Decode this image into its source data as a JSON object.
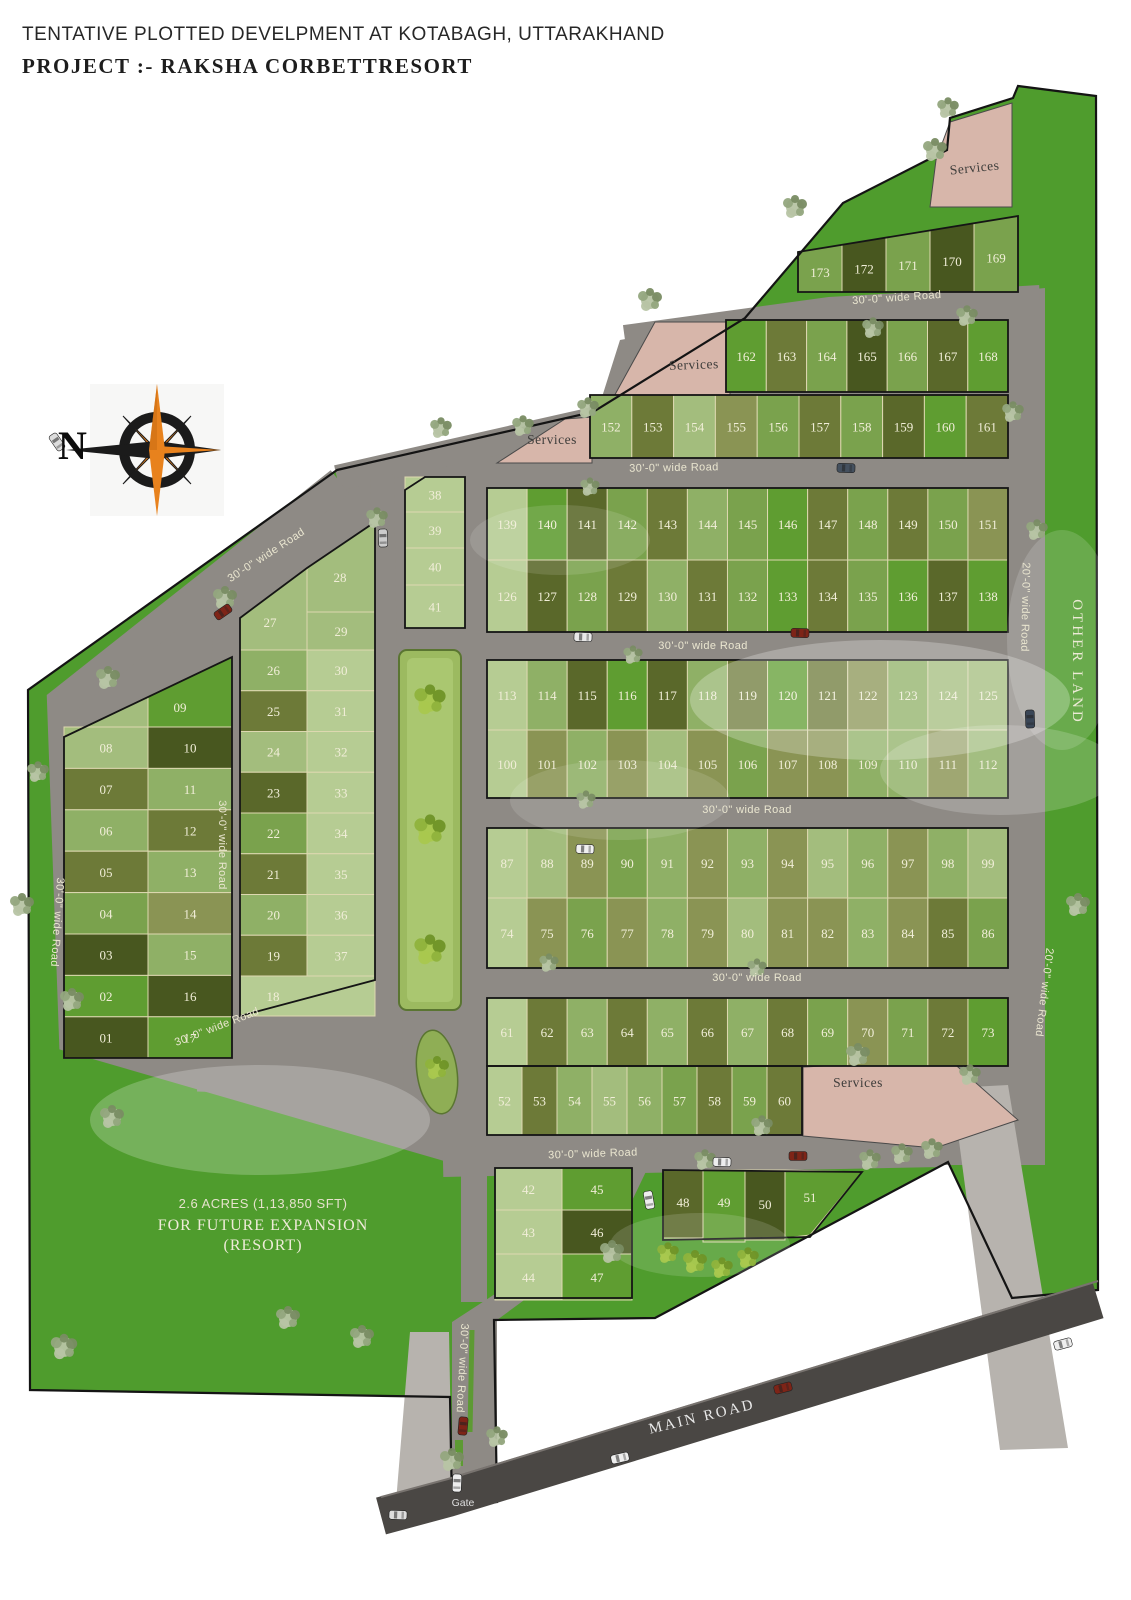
{
  "title": {
    "line1": "TENTATIVE PLOTTED DEVELPMENT AT KOTABAGH, UTTARAKHAND",
    "line2": "PROJECT :- RAKSHA CORBETTRESORT"
  },
  "compass": {
    "north_label": "N"
  },
  "labels": {
    "road_30": "30'-0\" wide Road",
    "road_20": "20'-0\" wide Road",
    "main_road": "MAIN ROAD",
    "gate": "Gate",
    "services": "Services",
    "other_land": "OTHER LAND",
    "future": [
      "2.6 ACRES (1,13,850 SFT)",
      "FOR FUTURE EXPANSION",
      "(RESORT)"
    ]
  },
  "colors": {
    "site_green": "#4f9c2d",
    "road_gray": "#8e8a85",
    "main_road_gray": "#4a4744",
    "path_gray": "#b7b3ae",
    "services_pink": "#d7b6aa",
    "park_green": "#9cba60",
    "compass_orange": "#e8821d",
    "compass_black": "#1b1b1b",
    "plot_palette": {
      "pale": "#b6cc93",
      "sage": "#a3bd7d",
      "sageD": "#8fb066",
      "med": "#7aa24d",
      "bright": "#5f9d31",
      "oliveL": "#8a9454",
      "olive": "#6d7a38",
      "dark": "#5a682a",
      "deep": "#48571f"
    }
  },
  "plots": {
    "block_a": [
      "173",
      "172",
      "171",
      "170",
      "169"
    ],
    "block_b_upper": [
      "162",
      "163",
      "164",
      "165",
      "166",
      "167",
      "168"
    ],
    "block_b_lower": [
      "152",
      "153",
      "154",
      "155",
      "156",
      "157",
      "158",
      "159",
      "160",
      "161"
    ],
    "block_c_upper": [
      "139",
      "140",
      "141",
      "142",
      "143",
      "144",
      "145",
      "146",
      "147",
      "148",
      "149",
      "150",
      "151"
    ],
    "block_c_lower": [
      "126",
      "127",
      "128",
      "129",
      "130",
      "131",
      "132",
      "133",
      "134",
      "135",
      "136",
      "137",
      "138"
    ],
    "block_d_upper": [
      "113",
      "114",
      "115",
      "116",
      "117",
      "118",
      "119",
      "120",
      "121",
      "122",
      "123",
      "124",
      "125"
    ],
    "block_d_lower": [
      "100",
      "101",
      "102",
      "103",
      "104",
      "105",
      "106",
      "107",
      "108",
      "109",
      "110",
      "111",
      "112"
    ],
    "block_e_upper": [
      "87",
      "88",
      "89",
      "90",
      "91",
      "92",
      "93",
      "94",
      "95",
      "96",
      "97",
      "98",
      "99"
    ],
    "block_e_lower": [
      "74",
      "75",
      "76",
      "77",
      "78",
      "79",
      "80",
      "81",
      "82",
      "83",
      "84",
      "85",
      "86"
    ],
    "block_f_upper": [
      "61",
      "62",
      "63",
      "64",
      "65",
      "66",
      "67",
      "68",
      "69",
      "70",
      "71",
      "72",
      "73"
    ],
    "block_f_lower": [
      "52",
      "53",
      "54",
      "55",
      "56",
      "57",
      "58",
      "59",
      "60"
    ],
    "block_g_col1": [
      "42",
      "43",
      "44"
    ],
    "block_g_col2": [
      "45",
      "46",
      "47"
    ],
    "block_g_right": [
      "48",
      "49",
      "50",
      "51"
    ],
    "block_h_col1": [
      "08",
      "07",
      "06",
      "05",
      "04",
      "03",
      "02",
      "01"
    ],
    "block_h_col2": [
      "09",
      "10",
      "11",
      "12",
      "13",
      "14",
      "15",
      "16",
      "17"
    ],
    "block_i_col1": [
      "27",
      "26",
      "25",
      "24",
      "23",
      "22",
      "21",
      "20",
      "19",
      "18"
    ],
    "block_i_col2": [
      "28",
      "29",
      "30",
      "31",
      "32",
      "33",
      "34",
      "35",
      "36",
      "37"
    ],
    "block_j": [
      "38",
      "39",
      "40",
      "41"
    ]
  }
}
